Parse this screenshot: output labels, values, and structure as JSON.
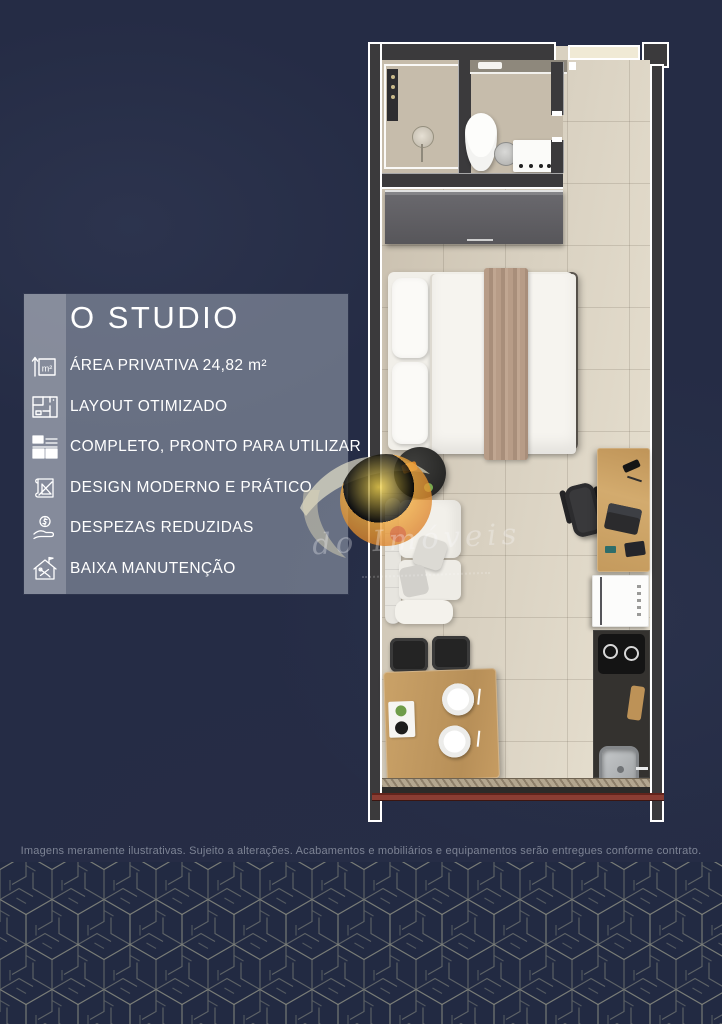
{
  "page": {
    "disclaimer": "Imagens meramente ilustrativas. Sujeito a alterações. Acabamentos e mobiliários e equipamentos serão entregues conforme contrato."
  },
  "info_panel": {
    "title": "O STUDIO",
    "area_icon_label": "m²",
    "features": [
      {
        "icon": "area-icon",
        "label": "ÁREA PRIVATIVA 24,82 m²"
      },
      {
        "icon": "floorplan-icon",
        "label": "LAYOUT OTIMIZADO"
      },
      {
        "icon": "kitchen-icon",
        "label": "COMPLETO, PRONTO PARA UTILIZAR"
      },
      {
        "icon": "blueprint-icon",
        "label": "DESIGN MODERNO E PRÁTICO"
      },
      {
        "icon": "coin-hand-icon",
        "label": "DESPEZAS REDUZIDAS"
      },
      {
        "icon": "house-tools-icon",
        "label": "BAIXA MANUTENÇÃO"
      }
    ]
  },
  "watermark": {
    "script_text": "do Imóveis"
  },
  "colors": {
    "background_navy": "#252c45",
    "panel_gray": "rgba(148,156,172,0.60)",
    "wall_charcoal": "#3b3a3c",
    "floor_beige": "#d8d0c0",
    "wood": "#c49a5f",
    "window_red": "#8a3d33",
    "logo_orange": "#ed9f39",
    "pattern_line": "#8f9184"
  }
}
